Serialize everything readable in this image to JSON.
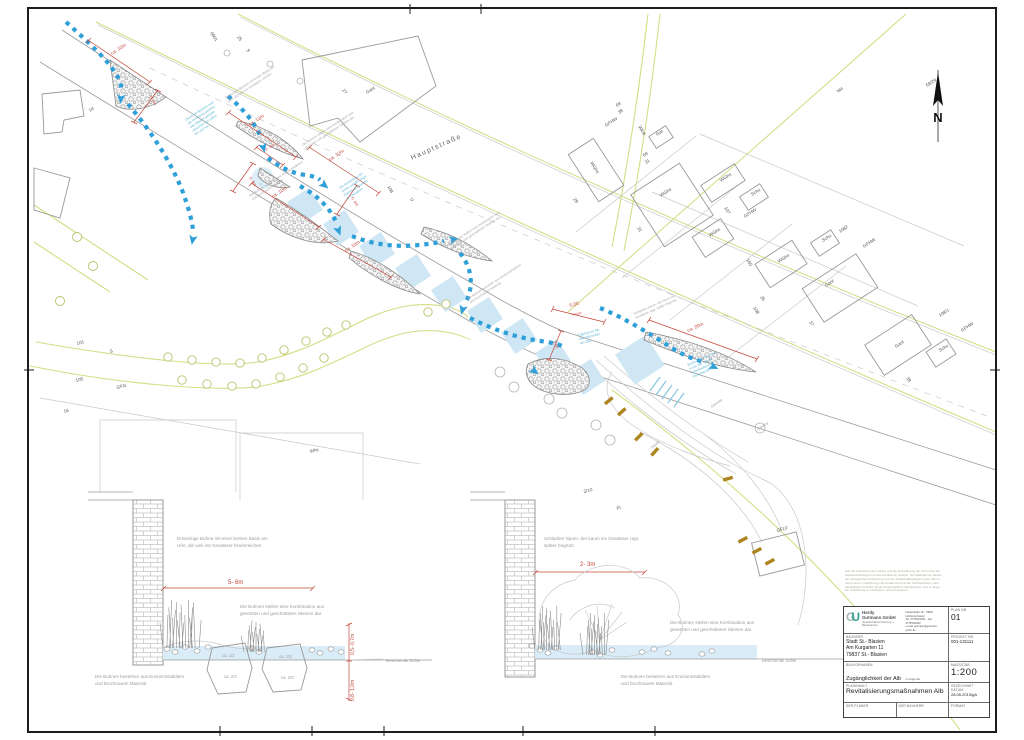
{
  "plan": {
    "north_letter": "N",
    "street": {
      "label": "Hauptstraße"
    },
    "cadastral_labels": [
      {
        "t": "14",
        "x": 90,
        "y": 112,
        "r": -33
      },
      {
        "t": "0801",
        "x": 210,
        "y": 33,
        "r": 57
      },
      {
        "t": "25",
        "x": 237,
        "y": 37,
        "r": 57
      },
      {
        "t": "S",
        "x": 246,
        "y": 50,
        "r": 57
      },
      {
        "t": "27",
        "x": 342,
        "y": 90,
        "r": 57
      },
      {
        "t": "Gast",
        "x": 367,
        "y": 94,
        "r": -33
      },
      {
        "t": "108",
        "x": 387,
        "y": 187,
        "r": 57
      },
      {
        "t": "U",
        "x": 410,
        "y": 199,
        "r": 57
      },
      {
        "t": "29",
        "x": 573,
        "y": 199,
        "r": 57
      },
      {
        "t": "69",
        "x": 617,
        "y": 107,
        "r": -33
      },
      {
        "t": "38",
        "x": 619,
        "y": 114,
        "r": -33
      },
      {
        "t": "GFHW",
        "x": 606,
        "y": 127,
        "r": -33
      },
      {
        "t": "Wkst",
        "x": 638,
        "y": 127,
        "r": 57
      },
      {
        "t": "Gar",
        "x": 657,
        "y": 136,
        "r": -33
      },
      {
        "t": "69",
        "x": 644,
        "y": 157,
        "r": -33
      },
      {
        "t": "31",
        "x": 646,
        "y": 164,
        "r": -33
      },
      {
        "t": "WGhs",
        "x": 590,
        "y": 163,
        "r": 57
      },
      {
        "t": "WGhs",
        "x": 661,
        "y": 197,
        "r": -33
      },
      {
        "t": "31",
        "x": 637,
        "y": 228,
        "r": 57
      },
      {
        "t": "WGhs",
        "x": 721,
        "y": 182,
        "r": -33
      },
      {
        "t": "Schu",
        "x": 752,
        "y": 196,
        "r": -33
      },
      {
        "t": "107",
        "x": 724,
        "y": 208,
        "r": 57
      },
      {
        "t": "GFHW",
        "x": 745,
        "y": 218,
        "r": -33
      },
      {
        "t": "WGhs",
        "x": 710,
        "y": 237,
        "r": -33
      },
      {
        "t": "160",
        "x": 746,
        "y": 260,
        "r": 57
      },
      {
        "t": "WGhs",
        "x": 779,
        "y": 263,
        "r": -33
      },
      {
        "t": "Schu",
        "x": 823,
        "y": 242,
        "r": -33
      },
      {
        "t": "1082",
        "x": 840,
        "y": 233,
        "r": -33
      },
      {
        "t": "GFHW",
        "x": 864,
        "y": 248,
        "r": -33
      },
      {
        "t": "Gast",
        "x": 826,
        "y": 287,
        "r": -33
      },
      {
        "t": "35",
        "x": 760,
        "y": 297,
        "r": 57
      },
      {
        "t": "108",
        "x": 753,
        "y": 308,
        "r": 57
      },
      {
        "t": "37",
        "x": 809,
        "y": 322,
        "r": 57
      },
      {
        "t": "Gast",
        "x": 896,
        "y": 348,
        "r": -33
      },
      {
        "t": "Schu",
        "x": 940,
        "y": 352,
        "r": -33
      },
      {
        "t": "108/1",
        "x": 940,
        "y": 317,
        "r": -33
      },
      {
        "t": "GFHW",
        "x": 962,
        "y": 332,
        "r": -33
      },
      {
        "t": "39",
        "x": 906,
        "y": 378,
        "r": 57
      },
      {
        "t": "NH",
        "x": 838,
        "y": 93,
        "r": -33
      },
      {
        "t": "69/29",
        "x": 927,
        "y": 87,
        "r": -33
      },
      {
        "t": "101",
        "x": 77,
        "y": 345,
        "r": -14
      },
      {
        "t": "S",
        "x": 110,
        "y": 353,
        "r": -14
      },
      {
        "t": "105",
        "x": 76,
        "y": 382,
        "r": -14
      },
      {
        "t": "GFG",
        "x": 117,
        "y": 389,
        "r": -14
      },
      {
        "t": "16",
        "x": 64,
        "y": 413,
        "r": -14
      },
      {
        "t": "Whs",
        "x": 310,
        "y": 453,
        "r": -14
      },
      {
        "t": "2/10",
        "x": 584,
        "y": 493,
        "r": -14
      },
      {
        "t": "Pl",
        "x": 617,
        "y": 510,
        "r": -14
      },
      {
        "t": "GFLF",
        "x": 777,
        "y": 532,
        "r": -14
      }
    ],
    "dim_labels": [
      {
        "t": "ca. 10m",
        "x": 112,
        "y": 55,
        "r": -33
      },
      {
        "t": "5- 6m",
        "x": 149,
        "y": 97,
        "r": 57,
        "s": 4
      },
      {
        "t": "ca. 12m",
        "x": 250,
        "y": 126,
        "r": -33
      },
      {
        "t": "2- 3m",
        "x": 266,
        "y": 151,
        "r": -33,
        "s": 4
      },
      {
        "t": "5- 6m",
        "x": 249,
        "y": 178,
        "r": 57,
        "s": 4
      },
      {
        "t": "ca. 12m",
        "x": 330,
        "y": 161,
        "r": -33
      },
      {
        "t": "5- 6m",
        "x": 351,
        "y": 198,
        "r": 57,
        "s": 4
      },
      {
        "t": "ca. 10m",
        "x": 273,
        "y": 198,
        "r": -33
      },
      {
        "t": "ca. 10m",
        "x": 346,
        "y": 252,
        "r": -33
      },
      {
        "t": "5,00",
        "x": 570,
        "y": 307,
        "r": -14
      },
      {
        "t": "Treppe",
        "x": 572,
        "y": 316,
        "r": -14,
        "s": 3.2
      },
      {
        "t": "2,50",
        "x": 553,
        "y": 342,
        "r": 62,
        "s": 4
      },
      {
        "t": "ca. 20m",
        "x": 688,
        "y": 332,
        "r": -24
      }
    ],
    "teal_notes": [
      {
        "x": 186,
        "y": 121,
        "r": -33,
        "lines": [
          "Durch die Buhnen wird",
          "die Strömung gelenkt,",
          "das Wasser pendelt",
          "zwischen den Ufern",
          "hin und her."
        ]
      },
      {
        "x": 340,
        "y": 189,
        "r": -33,
        "lines": [
          "Die Aufweitung der",
          "Sohle schafft ruhige",
          "Flachwasserzonen",
          "im Gewässer."
        ]
      },
      {
        "x": 578,
        "y": 336,
        "r": -14,
        "lines": [
          "Zugang zur Alb",
          "über Sitzstufen",
          "am Ufer."
        ]
      },
      {
        "x": 688,
        "y": 366,
        "r": -24,
        "lines": [
          "Breite (ca. 4-5m) Furt",
          "in der Alb, die als",
          "Aufenthaltsort im",
          "Flussbett dient."
        ]
      }
    ],
    "gray_notes": [
      {
        "x": 226,
        "y": 99,
        "r": -33,
        "lines": [
          "Dreieckige Buhnen mit breiter Basis am",
          "Ufer, die weit ins Gewässer reichen."
        ]
      },
      {
        "x": 303,
        "y": 146,
        "r": -33,
        "lines": [
          "Die Buhnen stellen eine Kombination aus",
          "gesetzten und geschütteten Steinen dar."
        ]
      },
      {
        "x": 250,
        "y": 197,
        "r": -33,
        "lines": [
          "Die Buhnen bestehen aus erosionsstabilem",
          "und bruchrauem Material."
        ]
      },
      {
        "x": 449,
        "y": 246,
        "r": -33,
        "lines": [
          "Die Buhnen stellen eine Kombination aus",
          "gesetzten und geschütteten Steinen dar."
        ]
      },
      {
        "x": 468,
        "y": 300,
        "r": -33,
        "lines": [
          "Die Buhnen bestehen aus erosionsstabilem",
          "und bruchrauem Material."
        ]
      },
      {
        "x": 634,
        "y": 315,
        "r": -24,
        "lines": [
          "Schlanker Sporn, der kaum ins",
          "Gewässer ragt, später begrünt."
        ]
      }
    ],
    "tiny_labels": [
      {
        "t": "Gehweg",
        "x": 712,
        "y": 408,
        "r": -37
      },
      {
        "t": "Treppe",
        "x": 652,
        "y": 449,
        "r": -43
      },
      {
        "t": "Gehweg",
        "x": 758,
        "y": 431,
        "r": -37
      }
    ]
  },
  "sections": {
    "left": {
      "texts": [
        {
          "lines": [
            "Dreieckige Buhne mit einer breiten Basis am",
            "Ufer, die weit ins Gewässer hineinreichen."
          ],
          "x": 177,
          "y": 540,
          "lh": 7
        },
        {
          "t": "5- 6m",
          "x": 228,
          "y": 584,
          "cls": "dim",
          "s": 6
        },
        {
          "lines": [
            "Die Buhnen stellen eine Kombination aus",
            "gesetzten und geschütteten Steinen dar."
          ],
          "x": 240,
          "y": 608,
          "lh": 7
        },
        {
          "lines": [
            "Die Buhnen bestehen aus Erosionsstabilem",
            "und bruchrauem Material."
          ],
          "x": 95,
          "y": 678,
          "lh": 7
        },
        {
          "t": "ca. 1/3",
          "x": 222,
          "y": 657,
          "cls": "gsm"
        },
        {
          "t": "ca. 2/3",
          "x": 224,
          "y": 678,
          "cls": "gsm"
        },
        {
          "t": "ca. 1/3",
          "x": 279,
          "y": 658,
          "cls": "gsm"
        },
        {
          "t": "ca. 2/3",
          "x": 281,
          "y": 679,
          "cls": "gsm"
        },
        {
          "t": "Bestehende Sohle",
          "x": 386,
          "y": 662,
          "cls": "gsm"
        },
        {
          "t": "0,5- 0,7m",
          "x": 354,
          "y": 655,
          "r": -90,
          "cls": "dim",
          "s": 5
        },
        {
          "t": "0,8- 1,0m",
          "x": 354,
          "y": 701,
          "r": -90,
          "cls": "dim",
          "s": 5
        }
      ]
    },
    "right": {
      "texts": [
        {
          "lines": [
            "Schlanker Sporn, der kaum ins Gewässer ragt,",
            "später begrünt."
          ],
          "x": 544,
          "y": 540,
          "lh": 7
        },
        {
          "t": "2- 3m",
          "x": 580,
          "y": 566,
          "cls": "dim",
          "s": 6
        },
        {
          "lines": [
            "Die Buhnen stellen eine Kombination aus",
            "gesetzten und geschütteten Steinen dar."
          ],
          "x": 670,
          "y": 624,
          "lh": 7
        },
        {
          "lines": [
            "Die Buhnen bestehen aus Erosionsstabilem",
            "und bruchrauem Material."
          ],
          "x": 621,
          "y": 678,
          "lh": 7
        },
        {
          "t": "Bestehende Sohle",
          "x": 762,
          "y": 662,
          "cls": "gsm"
        }
      ]
    }
  },
  "legal_note_lines": [
    "Erst die Aufweitung des Laufes und die Auflockerung der Ufer ist für die",
    "Gewässerökologie und das Ortsbild ein Gewinn. Die Maßnahmen dienen",
    "der ökologischen Aufwertung und der Attraktivitätssteigerung der Alb im",
    "Ortszentrum. Ausführung und Details sind mit den Fachbehörden, dem",
    "Landratsamt und dem Regierungspräsidium abzustimmen und im Zuge",
    "der Ausführung zu präzisieren und anzupassen."
  ],
  "titleblock": {
    "company": {
      "name": "Hardy\nGutmann GmbH",
      "subtitle": "Gesellschaft für Planung u. Bauberatung",
      "contact_lines": [
        "Hauptstraße 18 · 79862 Höchenschwand",
        "Tel. 07755/92091 · Fax 07755/92092",
        "e-mail: gutmann@gutmann-gmbh.de"
      ]
    },
    "captions": {
      "plan_nr": "PLAN NR.",
      "projekt_nr": "PROJEKT NR.",
      "massstab": "MASSSTAB",
      "gezeichnet": "GEZEICHNET · DATUM",
      "format": "FORMAT",
      "bauherr": "BAUHERR",
      "bauvorhaben": "BAUVORHABEN",
      "planinhalt": "PLANINHALT",
      "planer": "DER PLANER",
      "bauherr2": "DER BAUHERR"
    },
    "values": {
      "plan_nr": "01",
      "projekt_nr": "001-131111",
      "massstab": "1:200",
      "gezeichnet": "28.05.2013/gA",
      "format": "",
      "bauherr_lines": [
        "Stadt St.- Blasien",
        "Am Kurgarten 11",
        "79837 St.- Blasien"
      ],
      "bauvorhaben_main": "Zugänglichkeit der Alb",
      "bauvorhaben_sub": "im Zuge der Attraktivitätssteigerung",
      "planinhalt": "Revitalisierungsmaßnahmen Alb"
    }
  }
}
